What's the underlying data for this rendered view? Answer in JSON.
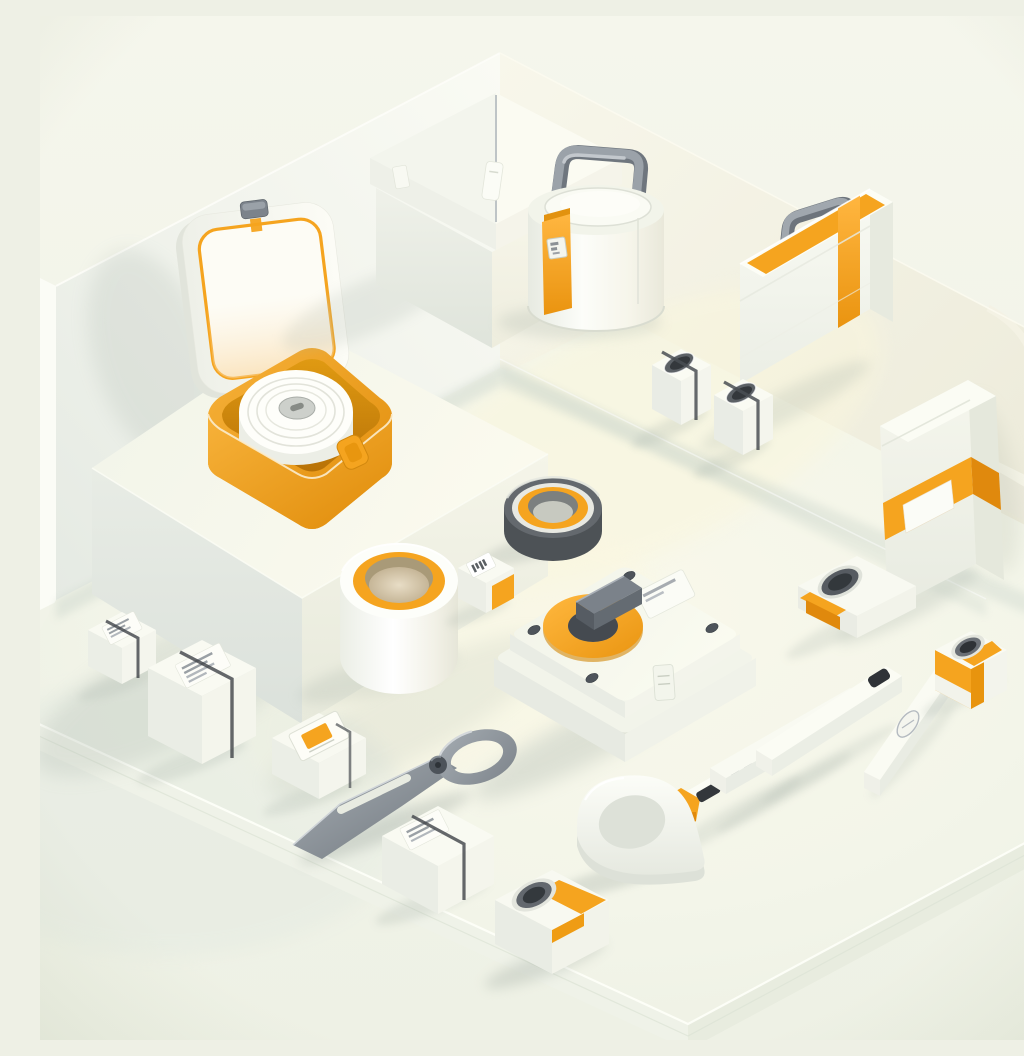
{
  "meta": {
    "title": "Isometric 3D render: white and orange first-aid style objects on a stepped cream diorama",
    "canvas": {
      "width": 1024,
      "height": 1024
    }
  },
  "palette": {
    "background": "#f2f4e9",
    "wall-light": "#f8f9f2",
    "wall-shade": "#e7ece5",
    "floor": "#f3f5e9",
    "floor-warm": "#f9f6e2",
    "white": "#fbfcf6",
    "white-shade": "#e9ece4",
    "orange": "#f5a41f",
    "orange-deep": "#e0890d",
    "amber": "#eda126",
    "amber-deep": "#c07707",
    "grey": "#8a9198",
    "slate": "#4a5056",
    "tan": "#cfc2a4",
    "shadow": "#a9b4aa"
  },
  "scene": {
    "description": "Soft 3D isometric illustration, no readable text; tiny printed glyphs on labels are illegible.",
    "objects": [
      {
        "id": "open-case",
        "label": "Open hinged case, white lid with orange rim, amber tray holding a rolled white bandage"
      },
      {
        "id": "carton-box",
        "label": "White carton box with centre lid seam and pull tab"
      },
      {
        "id": "canister",
        "label": "White canister with grey carry handle and orange label strip"
      },
      {
        "id": "briefcase",
        "label": "Slim white case with orange stripe and grey handle"
      },
      {
        "id": "latch-block-a",
        "label": "Small white block with dark recessed latch"
      },
      {
        "id": "latch-block-b",
        "label": "Small white block with dark recessed latch"
      },
      {
        "id": "banded-case",
        "label": "Standing white case with orange band and blank label"
      },
      {
        "id": "white-tape-roll",
        "label": "White tape roll with orange core ring"
      },
      {
        "id": "grey-tape-roll",
        "label": "Grey tape roll with orange core ring"
      },
      {
        "id": "barcode-box",
        "label": "Tiny white box with barcode sticker and orange patch"
      },
      {
        "id": "dispenser",
        "label": "White dispenser case with orange dial, grey lever and corner screws"
      },
      {
        "id": "blade-tool",
        "label": "Single-blade cutting tool with pivot screw and ring handle"
      },
      {
        "id": "label-box-1",
        "label": "Small white box with printed label and dark strap"
      },
      {
        "id": "label-box-2",
        "label": "White box with printed label and dark strap"
      },
      {
        "id": "label-box-3",
        "label": "White box with framed orange sticker"
      },
      {
        "id": "label-box-4",
        "label": "White box with printed label and dark strap"
      },
      {
        "id": "grip-ring",
        "label": "White teardrop grip ring"
      },
      {
        "id": "punch-block-a",
        "label": "White block with round port and orange band"
      },
      {
        "id": "punch-block-b",
        "label": "Flat white block with round port and orange corner"
      },
      {
        "id": "punch-block-c",
        "label": "Small white block with round port and orange wrap"
      },
      {
        "id": "test-stick",
        "label": "White stick with orange tips, dark slot and tiny glyphs"
      },
      {
        "id": "bar-plain",
        "label": "Plain white bar"
      },
      {
        "id": "bar-slotted",
        "label": "White bar with dark end slot"
      },
      {
        "id": "bar-embossed",
        "label": "White bar with embossed oval mark"
      }
    ]
  }
}
